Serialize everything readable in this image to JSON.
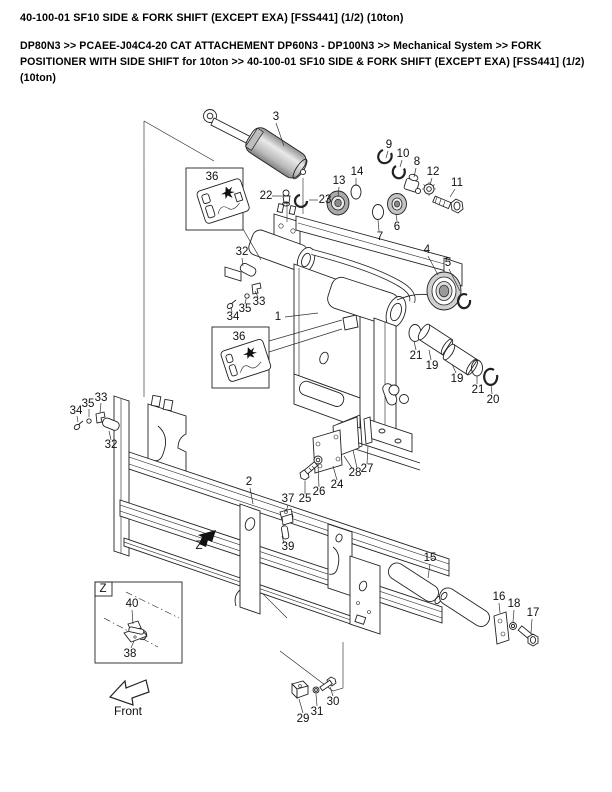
{
  "page": {
    "title": "40-100-01 SF10 SIDE & FORK SHIFT (EXCEPT EXA) [FSS441] (1/2) (10ton)",
    "breadcrumb": "DP80N3 >> PCAEE-J04C4-20 CAT ATTACHEMENT DP60N3 - DP100N3 >> Mechanical System >> FORK POSITIONER WITH SIDE SHIFT for 10ton >> 40-100-01 SF10 SIDE & FORK SHIFT (EXCEPT EXA) [FSS441] (1/2) (10ton)"
  },
  "diagram": {
    "type": "exploded-parts-view",
    "front_label": "Front",
    "detail_view_label": "Z",
    "colors": {
      "line": "#222222",
      "metal_gray": "#c8c8c8",
      "background": "#ffffff"
    },
    "callouts": [
      {
        "n": "3",
        "x": 276,
        "y": 117
      },
      {
        "n": "36",
        "x": 212,
        "y": 177
      },
      {
        "n": "22",
        "x": 266,
        "y": 196
      },
      {
        "n": "23",
        "x": 325,
        "y": 200
      },
      {
        "n": "13",
        "x": 339,
        "y": 181
      },
      {
        "n": "14",
        "x": 357,
        "y": 172
      },
      {
        "n": "9",
        "x": 389,
        "y": 145
      },
      {
        "n": "10",
        "x": 403,
        "y": 154
      },
      {
        "n": "8",
        "x": 417,
        "y": 162
      },
      {
        "n": "12",
        "x": 433,
        "y": 172
      },
      {
        "n": "11",
        "x": 457,
        "y": 183
      },
      {
        "n": "7",
        "x": 380,
        "y": 237
      },
      {
        "n": "6",
        "x": 397,
        "y": 227
      },
      {
        "n": "4",
        "x": 427,
        "y": 250
      },
      {
        "n": "5",
        "x": 448,
        "y": 263
      },
      {
        "n": "32",
        "x": 242,
        "y": 252
      },
      {
        "n": "33",
        "x": 259,
        "y": 302
      },
      {
        "n": "35",
        "x": 245,
        "y": 309
      },
      {
        "n": "34",
        "x": 233,
        "y": 317
      },
      {
        "n": "1",
        "x": 278,
        "y": 317
      },
      {
        "n": "36",
        "x": 239,
        "y": 337
      },
      {
        "n": "21",
        "x": 416,
        "y": 356
      },
      {
        "n": "19",
        "x": 432,
        "y": 366
      },
      {
        "n": "19",
        "x": 457,
        "y": 379
      },
      {
        "n": "21",
        "x": 478,
        "y": 390
      },
      {
        "n": "20",
        "x": 493,
        "y": 400
      },
      {
        "n": "33",
        "x": 101,
        "y": 398
      },
      {
        "n": "35",
        "x": 88,
        "y": 404
      },
      {
        "n": "34",
        "x": 76,
        "y": 411
      },
      {
        "n": "32",
        "x": 111,
        "y": 445
      },
      {
        "n": "2",
        "x": 249,
        "y": 482
      },
      {
        "n": "27",
        "x": 367,
        "y": 469
      },
      {
        "n": "28",
        "x": 355,
        "y": 473
      },
      {
        "n": "24",
        "x": 337,
        "y": 485
      },
      {
        "n": "26",
        "x": 319,
        "y": 492
      },
      {
        "n": "25",
        "x": 305,
        "y": 499
      },
      {
        "n": "37",
        "x": 288,
        "y": 499
      },
      {
        "n": "39",
        "x": 288,
        "y": 547
      },
      {
        "n": "Z",
        "x": 199,
        "y": 546
      },
      {
        "n": "15",
        "x": 430,
        "y": 558
      },
      {
        "n": "16",
        "x": 499,
        "y": 597
      },
      {
        "n": "18",
        "x": 514,
        "y": 604
      },
      {
        "n": "17",
        "x": 533,
        "y": 613
      },
      {
        "n": "40",
        "x": 132,
        "y": 604
      },
      {
        "n": "38",
        "x": 130,
        "y": 654
      },
      {
        "n": "Z",
        "x": 103,
        "y": 589
      },
      {
        "n": "29",
        "x": 303,
        "y": 719
      },
      {
        "n": "31",
        "x": 317,
        "y": 712
      },
      {
        "n": "30",
        "x": 333,
        "y": 702
      }
    ]
  }
}
